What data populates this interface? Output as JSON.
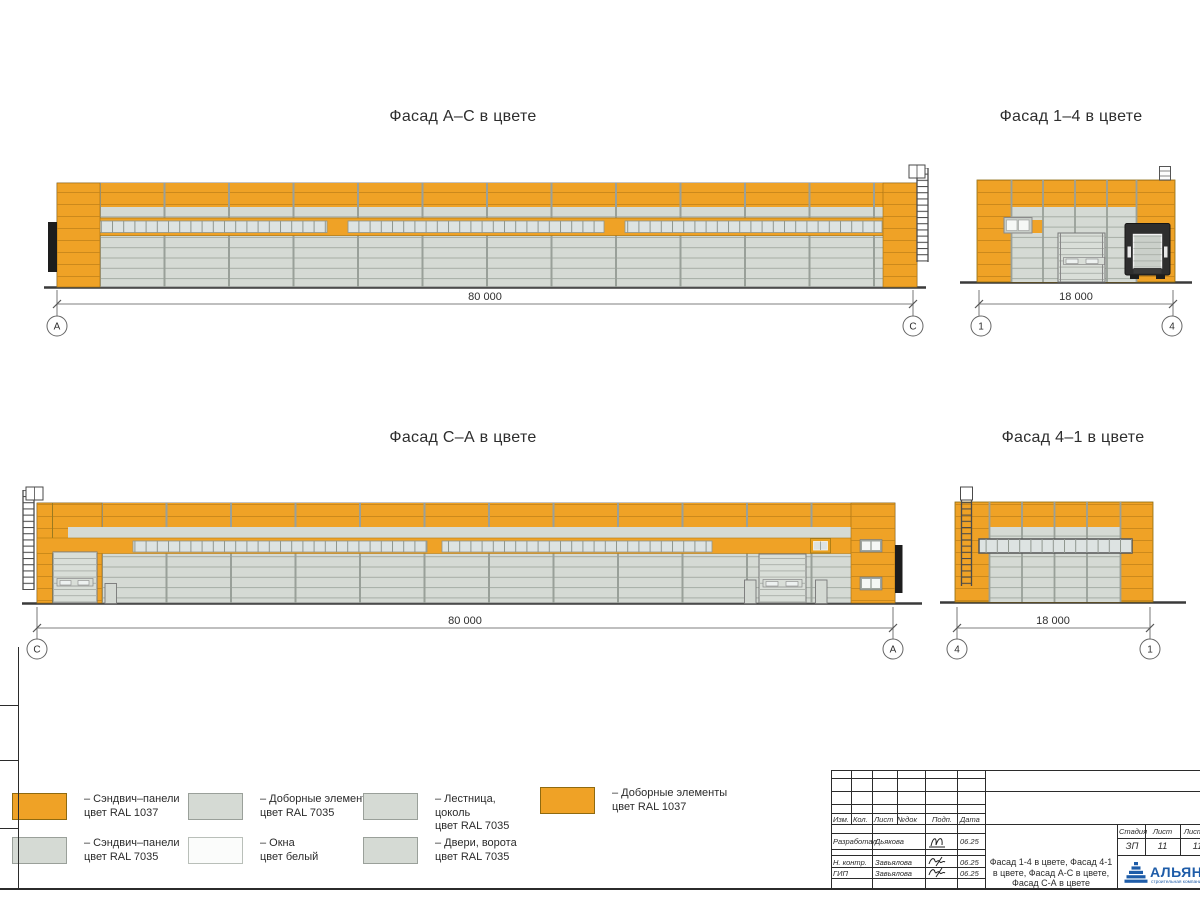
{
  "palette": {
    "sandwich_orange_ral1037": "#EFA226",
    "sandwich_gray_ral7035": "#D5DAD4",
    "window_pane": "#DDE3E2",
    "door_gray": "#D9DED8",
    "dark_element": "#1D1D1D",
    "logo_blue": "#1E5CA8"
  },
  "facades": [
    {
      "title": "Фасад А–С в цвете",
      "dimension": "80 000",
      "axis_left": "А",
      "axis_right": "С"
    },
    {
      "title": "Фасад 1–4 в цвете",
      "dimension": "18 000",
      "axis_left": "1",
      "axis_right": "4"
    },
    {
      "title": "Фасад С–А в цвете",
      "dimension": "80 000",
      "axis_left": "С",
      "axis_right": "А"
    },
    {
      "title": "Фасад 4–1 в цвете",
      "dimension": "18 000",
      "axis_left": "4",
      "axis_right": "1"
    }
  ],
  "legend": {
    "items": [
      {
        "l1": "– Сэндвич–панели",
        "l2": "цвет RAL 1037",
        "l3": ""
      },
      {
        "l1": "– Сэндвич–панели",
        "l2": "цвет RAL 7035",
        "l3": ""
      },
      {
        "l1": "– Доборные элементы",
        "l2": "цвет RAL 7035",
        "l3": ""
      },
      {
        "l1": "– Окна",
        "l2": "цвет белый",
        "l3": ""
      },
      {
        "l1": "– Лестница,",
        "l2": "цоколь",
        "l3": "цвет RAL 7035"
      },
      {
        "l1": "– Двери, ворота",
        "l2": "цвет RAL 7035",
        "l3": ""
      },
      {
        "l1": "– Доборные элементы",
        "l2": "цвет RAL 1037",
        "l3": ""
      }
    ]
  },
  "title_block": {
    "rev_headers": [
      "Изм.",
      "Кол.",
      "Лист",
      "№док",
      "Подп.",
      "Дата"
    ],
    "rows": [
      {
        "role": "Разработал",
        "name": "Дьякова",
        "date": "06.25"
      },
      {
        "role": "Н. контр.",
        "name": "Завьялова",
        "date": "06.25"
      },
      {
        "role": "ГИП",
        "name": "Завьялова",
        "date": "06.25"
      }
    ],
    "title": "Фасад 1-4 в цвете, Фасад 4-1 в цвете, Фасад А-С в цвете, Фасад С-А в цвете",
    "stage_header": "Стадия",
    "sheet_header": "Лист",
    "sheets_header": "Листов",
    "stage": "ЗП",
    "sheet_no": "11",
    "sheets_total": "11",
    "company": "АЛЬЯНС",
    "company_sub": "строительная компания"
  }
}
